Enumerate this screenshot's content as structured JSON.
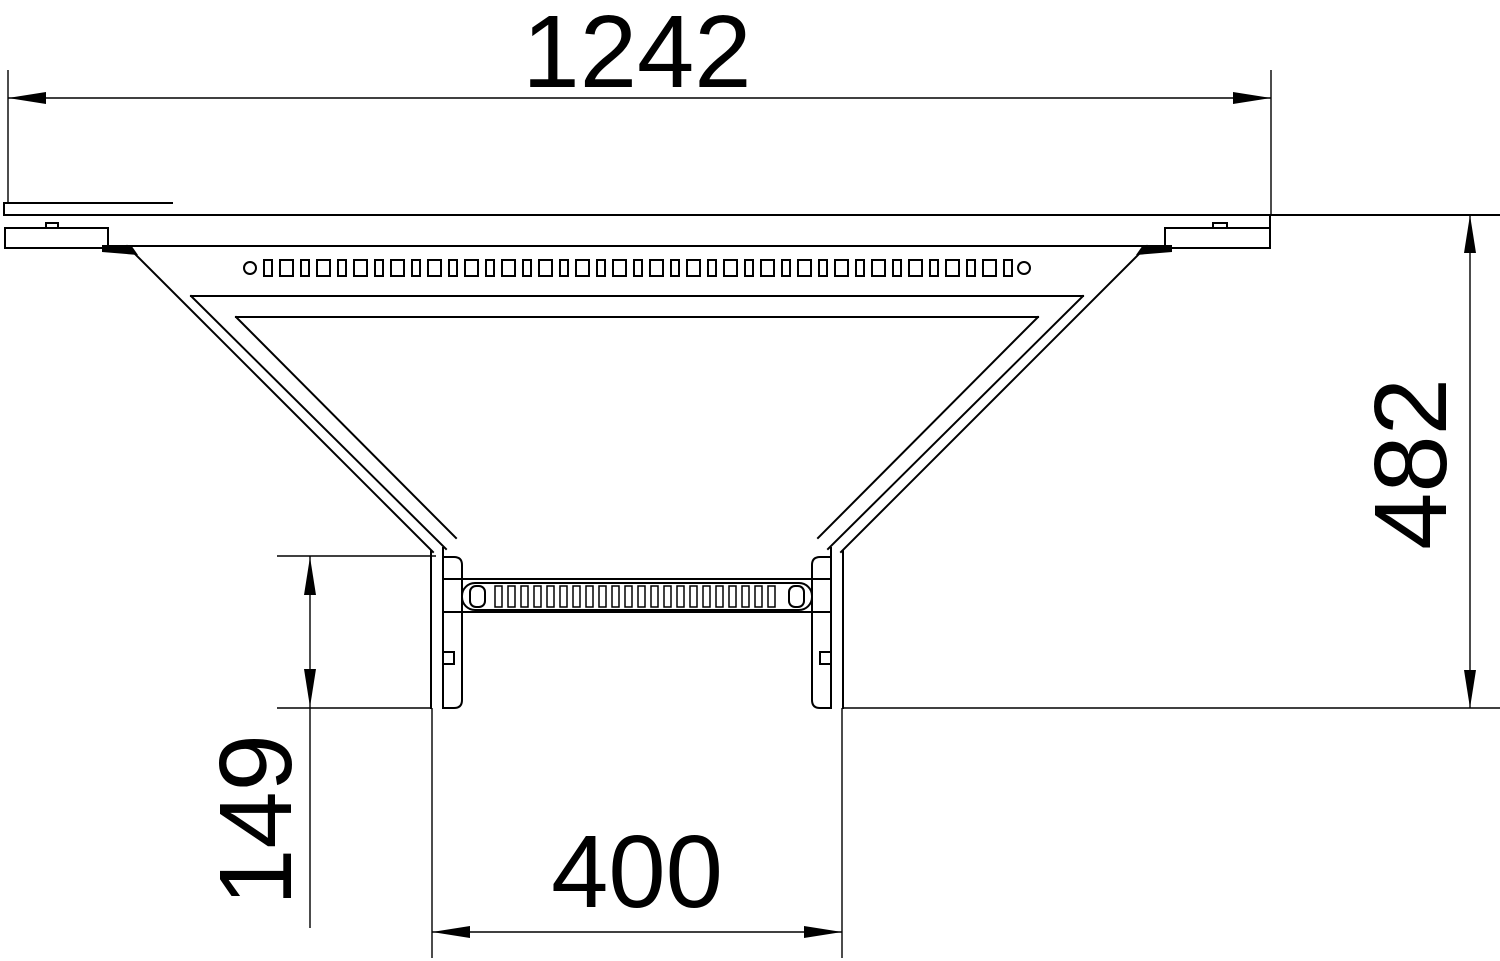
{
  "drawing": {
    "kind": "technical-dimension-drawing",
    "view": "plan-view-tee-branch-cable-ladder",
    "colors": {
      "line": "#000000",
      "background": "#ffffff"
    },
    "dimensions": {
      "top_width": "1242",
      "right_height": "482",
      "left_offset": "149",
      "bottom_width": "400"
    }
  }
}
